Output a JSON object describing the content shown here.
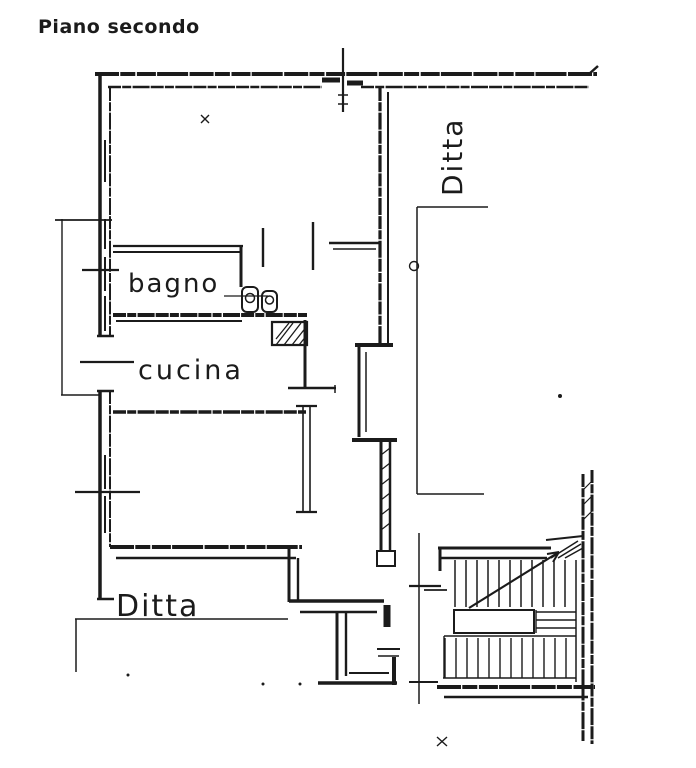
{
  "colors": {
    "background": "#ffffff",
    "ink": "#1b1b1b"
  },
  "title": "Piano secondo",
  "labels": {
    "room_bagno": "bagno",
    "room_cucina": "cucina",
    "unit_lower": "Ditta",
    "unit_right": "Ditta"
  }
}
